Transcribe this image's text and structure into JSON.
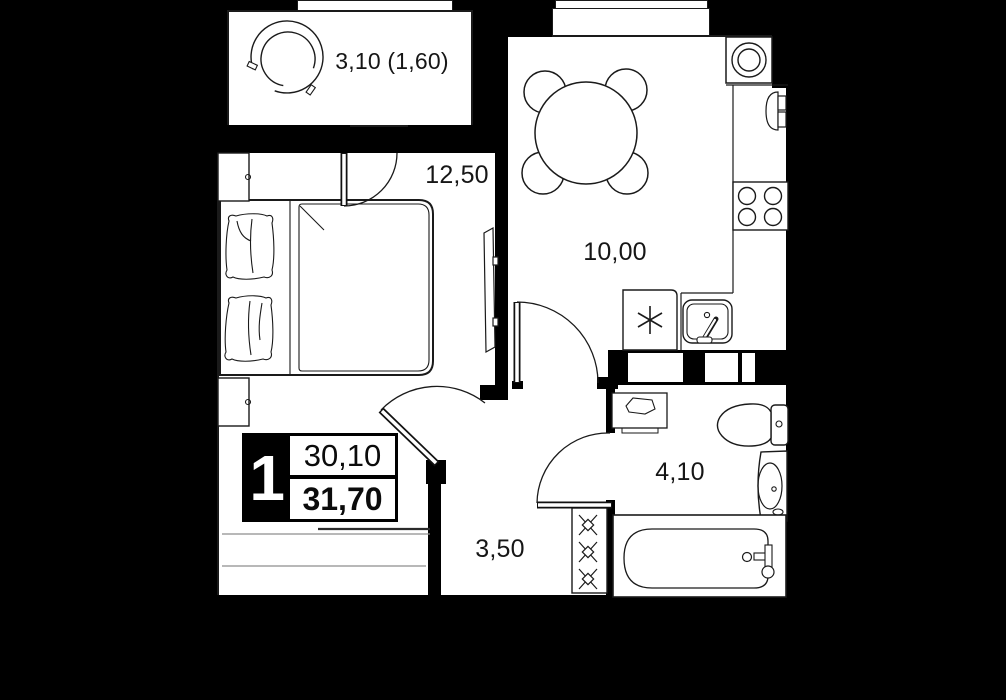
{
  "plan": {
    "info_badge": {
      "rooms_count": "1",
      "area_upper": "30,10",
      "area_lower": "31,70"
    },
    "rooms": [
      {
        "id": "balcony",
        "area_label": "3,10 (1,60)"
      },
      {
        "id": "bedroom",
        "area_label": "12,50"
      },
      {
        "id": "kitchen",
        "area_label": "10,00"
      },
      {
        "id": "hallway",
        "area_label": "3,50"
      },
      {
        "id": "bathroom",
        "area_label": "4,10"
      }
    ],
    "colors": {
      "background": "#000000",
      "floor": "#ffffff",
      "line": "#1a1a1a",
      "wall": "#000000"
    }
  }
}
